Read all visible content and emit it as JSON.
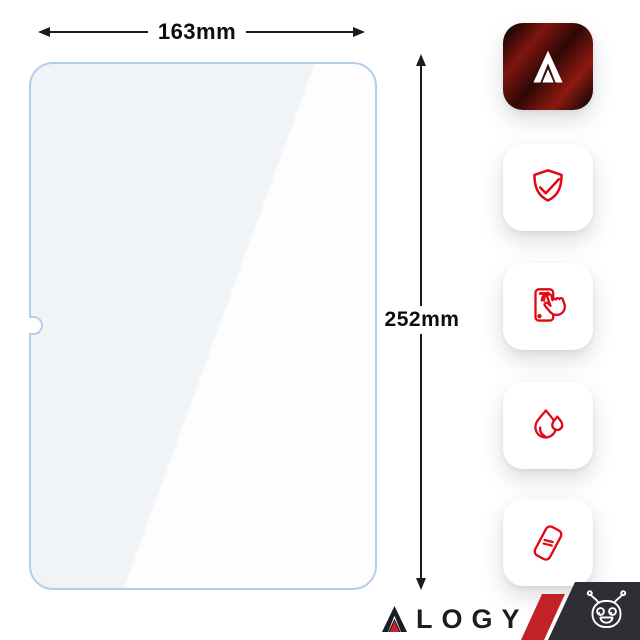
{
  "dimensions": {
    "width_label": "163mm",
    "height_label": "252mm"
  },
  "glass": {
    "name": "tempered-glass-screen-protector",
    "border_color": "#b3cfe9",
    "has_camera_notch": true
  },
  "feature_tiles": [
    {
      "icon": "alogy-logo-icon"
    },
    {
      "icon": "shield-check-icon"
    },
    {
      "icon": "touch-screen-icon"
    },
    {
      "icon": "water-drop-icon"
    },
    {
      "icon": "protector-film-icon"
    }
  ],
  "branding": {
    "wordmark": "ALOGY",
    "wordmark_rest": "LOGY",
    "mascot": "robot-mascot-icon"
  },
  "colors": {
    "accent_red": "#e30613",
    "stripe_red": "#c22127",
    "corner_dark": "#2e2f34",
    "arrow_black": "#1a1a1a",
    "text_dark": "#1b1d24",
    "logo_dark_red": "#8d1a10",
    "glass_border_blue": "#b3cfe9"
  }
}
